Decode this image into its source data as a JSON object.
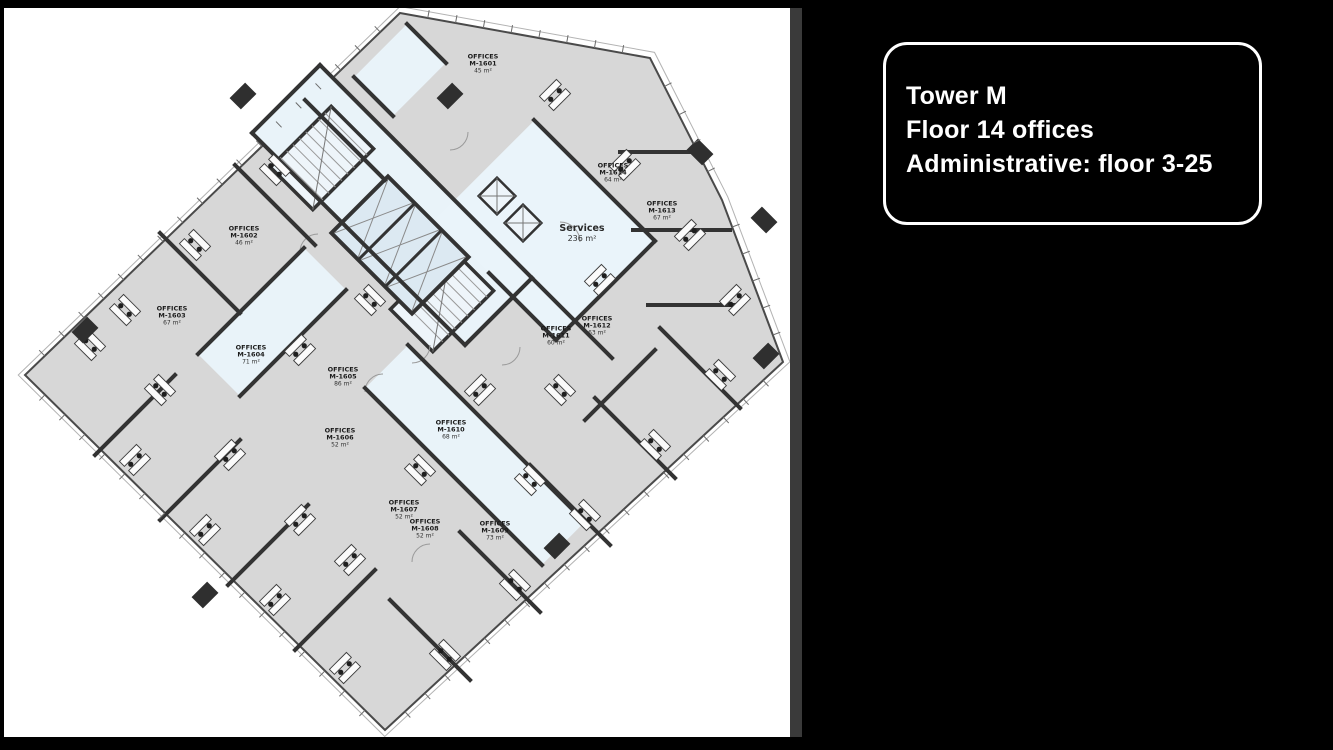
{
  "slide": {
    "right_panel": {
      "info_box": {
        "lines": [
          "Tower M",
          "Floor 14 offices",
          "Administrative: floor 3-25"
        ]
      }
    },
    "floor_plan": {
      "offices_word": "OFFICES",
      "services": {
        "label": "Services",
        "area": "236 m²",
        "x": 582,
        "y": 234
      },
      "offices": [
        {
          "id": "M-1601",
          "area": "45 m²",
          "x": 483,
          "y": 64
        },
        {
          "id": "M-1602",
          "area": "46 m²",
          "x": 244,
          "y": 236
        },
        {
          "id": "M-1603",
          "area": "67 m²",
          "x": 172,
          "y": 316
        },
        {
          "id": "M-1604",
          "area": "71 m²",
          "x": 251,
          "y": 355
        },
        {
          "id": "M-1605",
          "area": "86 m²",
          "x": 343,
          "y": 377
        },
        {
          "id": "M-1606",
          "area": "52 m²",
          "x": 340,
          "y": 438
        },
        {
          "id": "M-1607",
          "area": "52 m²",
          "x": 404,
          "y": 510
        },
        {
          "id": "M-1608",
          "area": "52 m²",
          "x": 425,
          "y": 529
        },
        {
          "id": "M-1609",
          "area": "73 m²",
          "x": 495,
          "y": 531
        },
        {
          "id": "M-1610",
          "area": "68 m²",
          "x": 451,
          "y": 430
        },
        {
          "id": "M-1611",
          "area": "60 m²",
          "x": 556,
          "y": 336
        },
        {
          "id": "M-1612",
          "area": "63 m²",
          "x": 597,
          "y": 326
        },
        {
          "id": "M-1613",
          "area": "67 m²",
          "x": 662,
          "y": 211
        },
        {
          "id": "M-1614",
          "area": "64 m²",
          "x": 613,
          "y": 173
        }
      ]
    },
    "colors": {
      "office_fill": "#d7d7d7",
      "core_fill": "#e9f3f9",
      "wall": "#333333",
      "outline": "#4a4a4a",
      "right_bg": "#000000",
      "box_border": "#ffffff"
    }
  }
}
